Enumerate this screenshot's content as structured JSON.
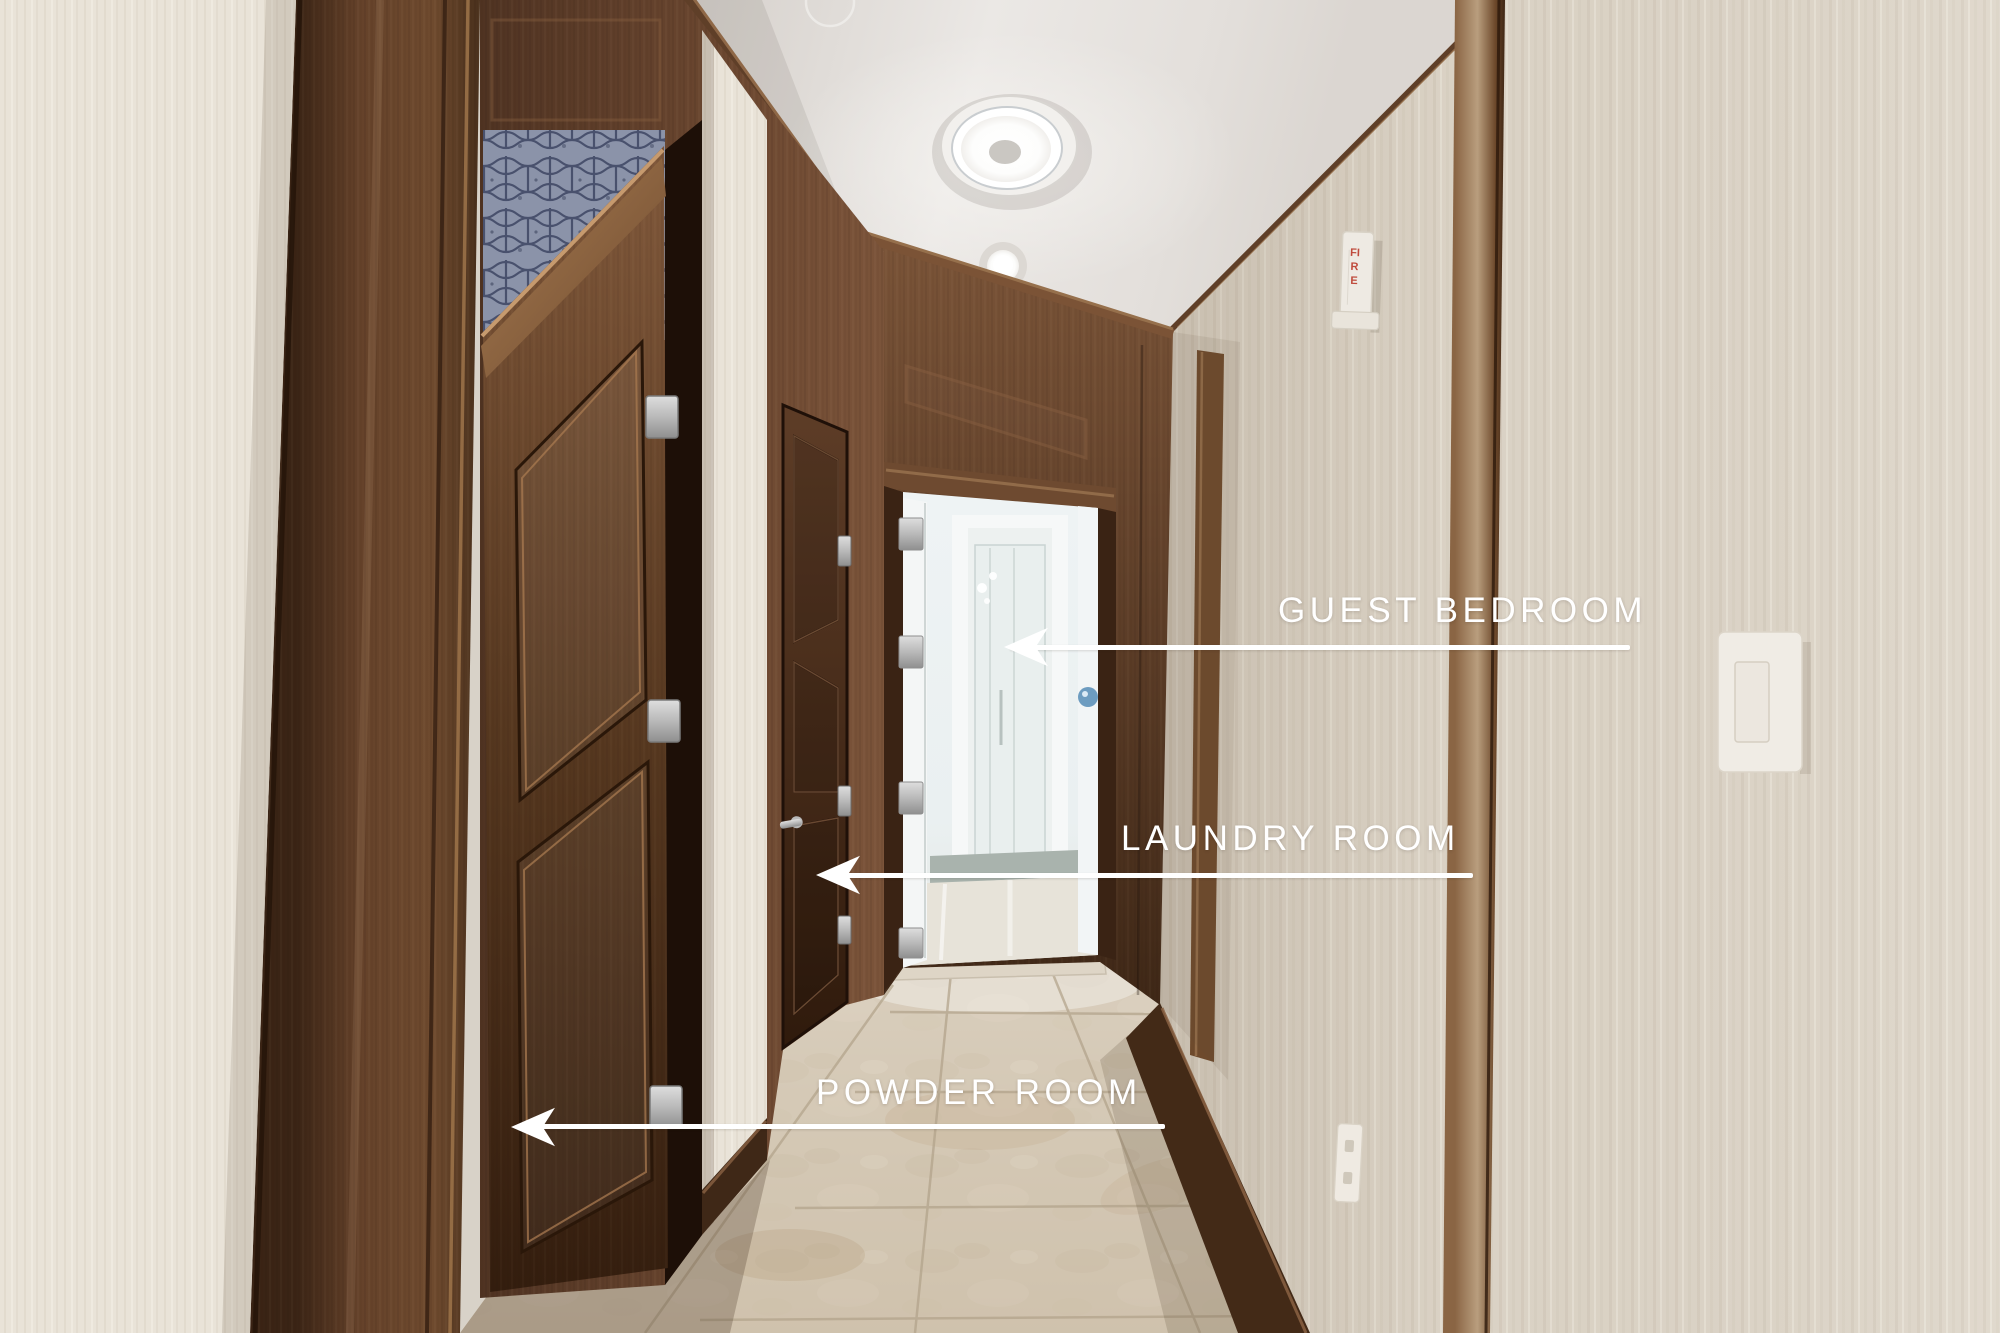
{
  "scene": {
    "description": "Interior hallway photo with dark wood doors and annotated room labels",
    "objects": [
      "ceiling-light",
      "recessed-light",
      "sprinkler-head",
      "fire-alarm-strobe",
      "light-switch",
      "wall-outlet",
      "powder-room-door",
      "laundry-room-door",
      "guest-bedroom-doorway",
      "travertine-floor",
      "wood-paneling",
      "wallpaper-walls"
    ]
  },
  "labels": {
    "guest": {
      "text": "GUEST BEDROOM",
      "arrow_direction": "left"
    },
    "laundry": {
      "text": "LAUNDRY ROOM",
      "arrow_direction": "left"
    },
    "powder": {
      "text": "POWDER ROOM",
      "arrow_direction": "left"
    }
  },
  "devices": {
    "fire_alarm_text": "FIRE"
  },
  "colors": {
    "label_text": "#ffffff",
    "arrow": "#ffffff",
    "wood_dark": "#3a2415",
    "wood_mid": "#6b4730",
    "wallpaper": "#ddd5c8",
    "ceiling": "#e6e2de",
    "floor": "#d3c6b3",
    "room_beyond": "#eef2f3",
    "transom_blue": "#8b93a9",
    "fire_text": "#bf4a3c"
  }
}
